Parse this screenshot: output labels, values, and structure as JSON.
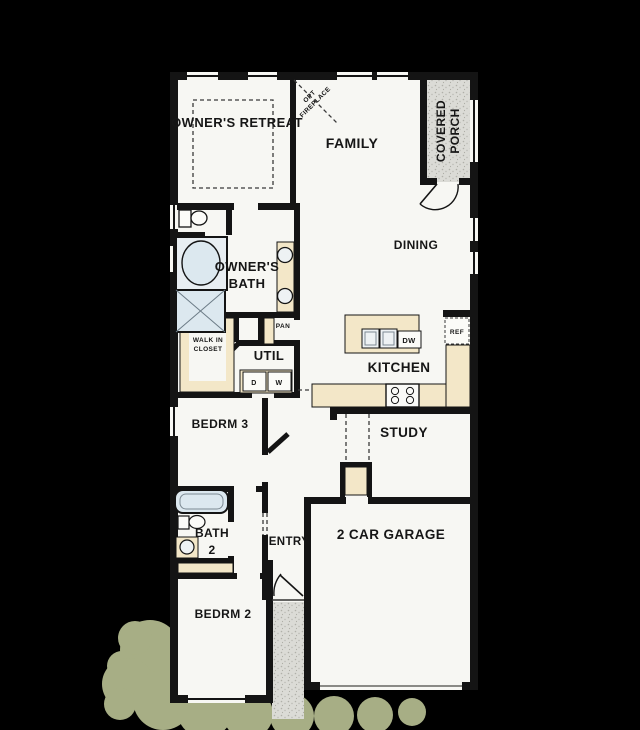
{
  "plan": {
    "type": "single-story residential floor plan",
    "colors": {
      "background": "#000000",
      "floor": "#f7f7f3",
      "walls": "#141414",
      "cabinetry_tan": "#f3e7c8",
      "fixture_blue": "#dce8ef",
      "porch_stipple": "#dbdbd6",
      "landscaping_green": "#a7ae85"
    },
    "labels": {
      "owners_retreat": "OWNER'S RETREAT",
      "opt_fireplace_line1": "OPT",
      "opt_fireplace_line2": "FIREPLACE",
      "family": "FAMILY",
      "covered_porch_line1": "COVERED",
      "covered_porch_line2": "PORCH",
      "dining": "DINING",
      "owners_bath_line1": "OWNER'S",
      "owners_bath_line2": "BATH",
      "pan": "PAN",
      "walk_in_closet_line1": "WALK IN",
      "walk_in_closet_line2": "CLOSET",
      "util": "UTIL",
      "dryer": "D",
      "washer": "W",
      "ref": "REF",
      "dishwasher": "DW",
      "kitchen": "KITCHEN",
      "bedroom3": "BEDRM 3",
      "study": "STUDY",
      "bath2_line1": "BATH",
      "bath2_line2": "2",
      "entry": "ENTRY",
      "garage": "2 CAR GARAGE",
      "bedroom2": "BEDRM 2"
    }
  }
}
